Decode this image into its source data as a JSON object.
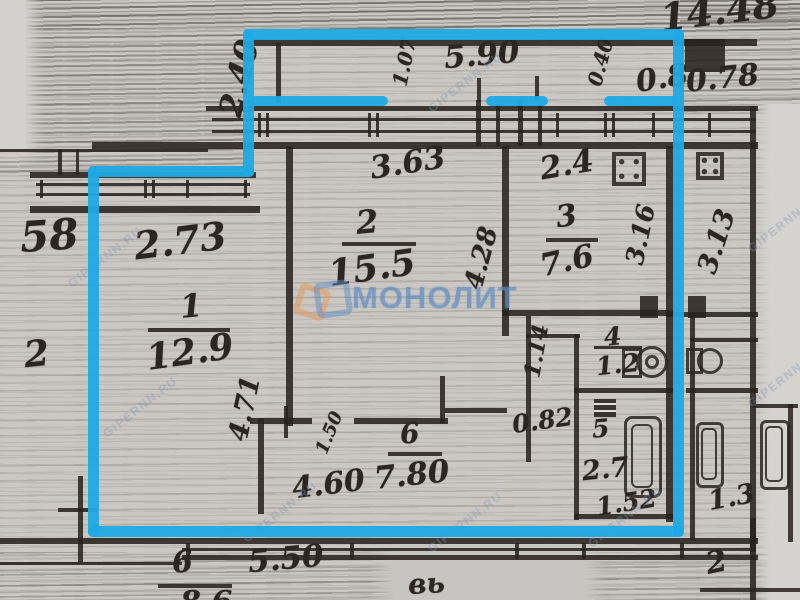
{
  "document": {
    "kind": "scanned apartment floor plan with highlighted unit outline",
    "colors": {
      "highlight": "#1fa9e4",
      "paper": "#cbc8c3",
      "ink": "#28231f",
      "watermark_blue": "#5f8cc3",
      "watermark_orange": "#e09a5f"
    }
  },
  "watermarks": {
    "center_text": "МОНОЛИТ",
    "diagonal_text": "GIPERNN.RU"
  },
  "rooms": [
    {
      "number": "1",
      "area": "12.9"
    },
    {
      "number": "2",
      "area": "15.5"
    },
    {
      "number": "3",
      "area": "7.6"
    },
    {
      "number": "4",
      "area": "1.2"
    },
    {
      "number": "5",
      "area": "2.7"
    },
    {
      "number": "6",
      "area": "7.80"
    }
  ],
  "labels": {
    "corner_number": "14.48",
    "dim_5_90": "5.90",
    "dim_0_8": "0.8",
    "dim_0_78": "0.78",
    "rot_balcony_left": "1.07",
    "rot_balcony_right": "0.40",
    "dim_2_40": "2.40",
    "num_58": "58",
    "dim_2_73": "2.73",
    "dim_3_63": "3.63",
    "room2_num": "2",
    "room2_area": "15.5",
    "room2_rot": "4.28",
    "room3_dim": "2.4",
    "room3_num": "3",
    "room3_area": "7.6",
    "room3_rot": "3.16",
    "neighbor_rot": "3.13",
    "room1_num": "1",
    "room1_area": "12.9",
    "room1_rot": "4.71",
    "left_num": "2",
    "rot_1_50": "1.50",
    "dim_4_60": "4.60",
    "room6_num": "6",
    "room6_area": "7.80",
    "dim_0_82": "0.82",
    "rot_1_14": "1.14",
    "room4_num": "4",
    "room4_area": "1.2",
    "room5_num": "5",
    "room5_area": "2.7",
    "dim_1_52": "1.52",
    "dim_1_3": "1.3",
    "bottom_num6": "6",
    "bottom_dim": "5.50",
    "bottom_script": "вь",
    "bottom_num2": "2",
    "bottom_partial": "8.6"
  }
}
